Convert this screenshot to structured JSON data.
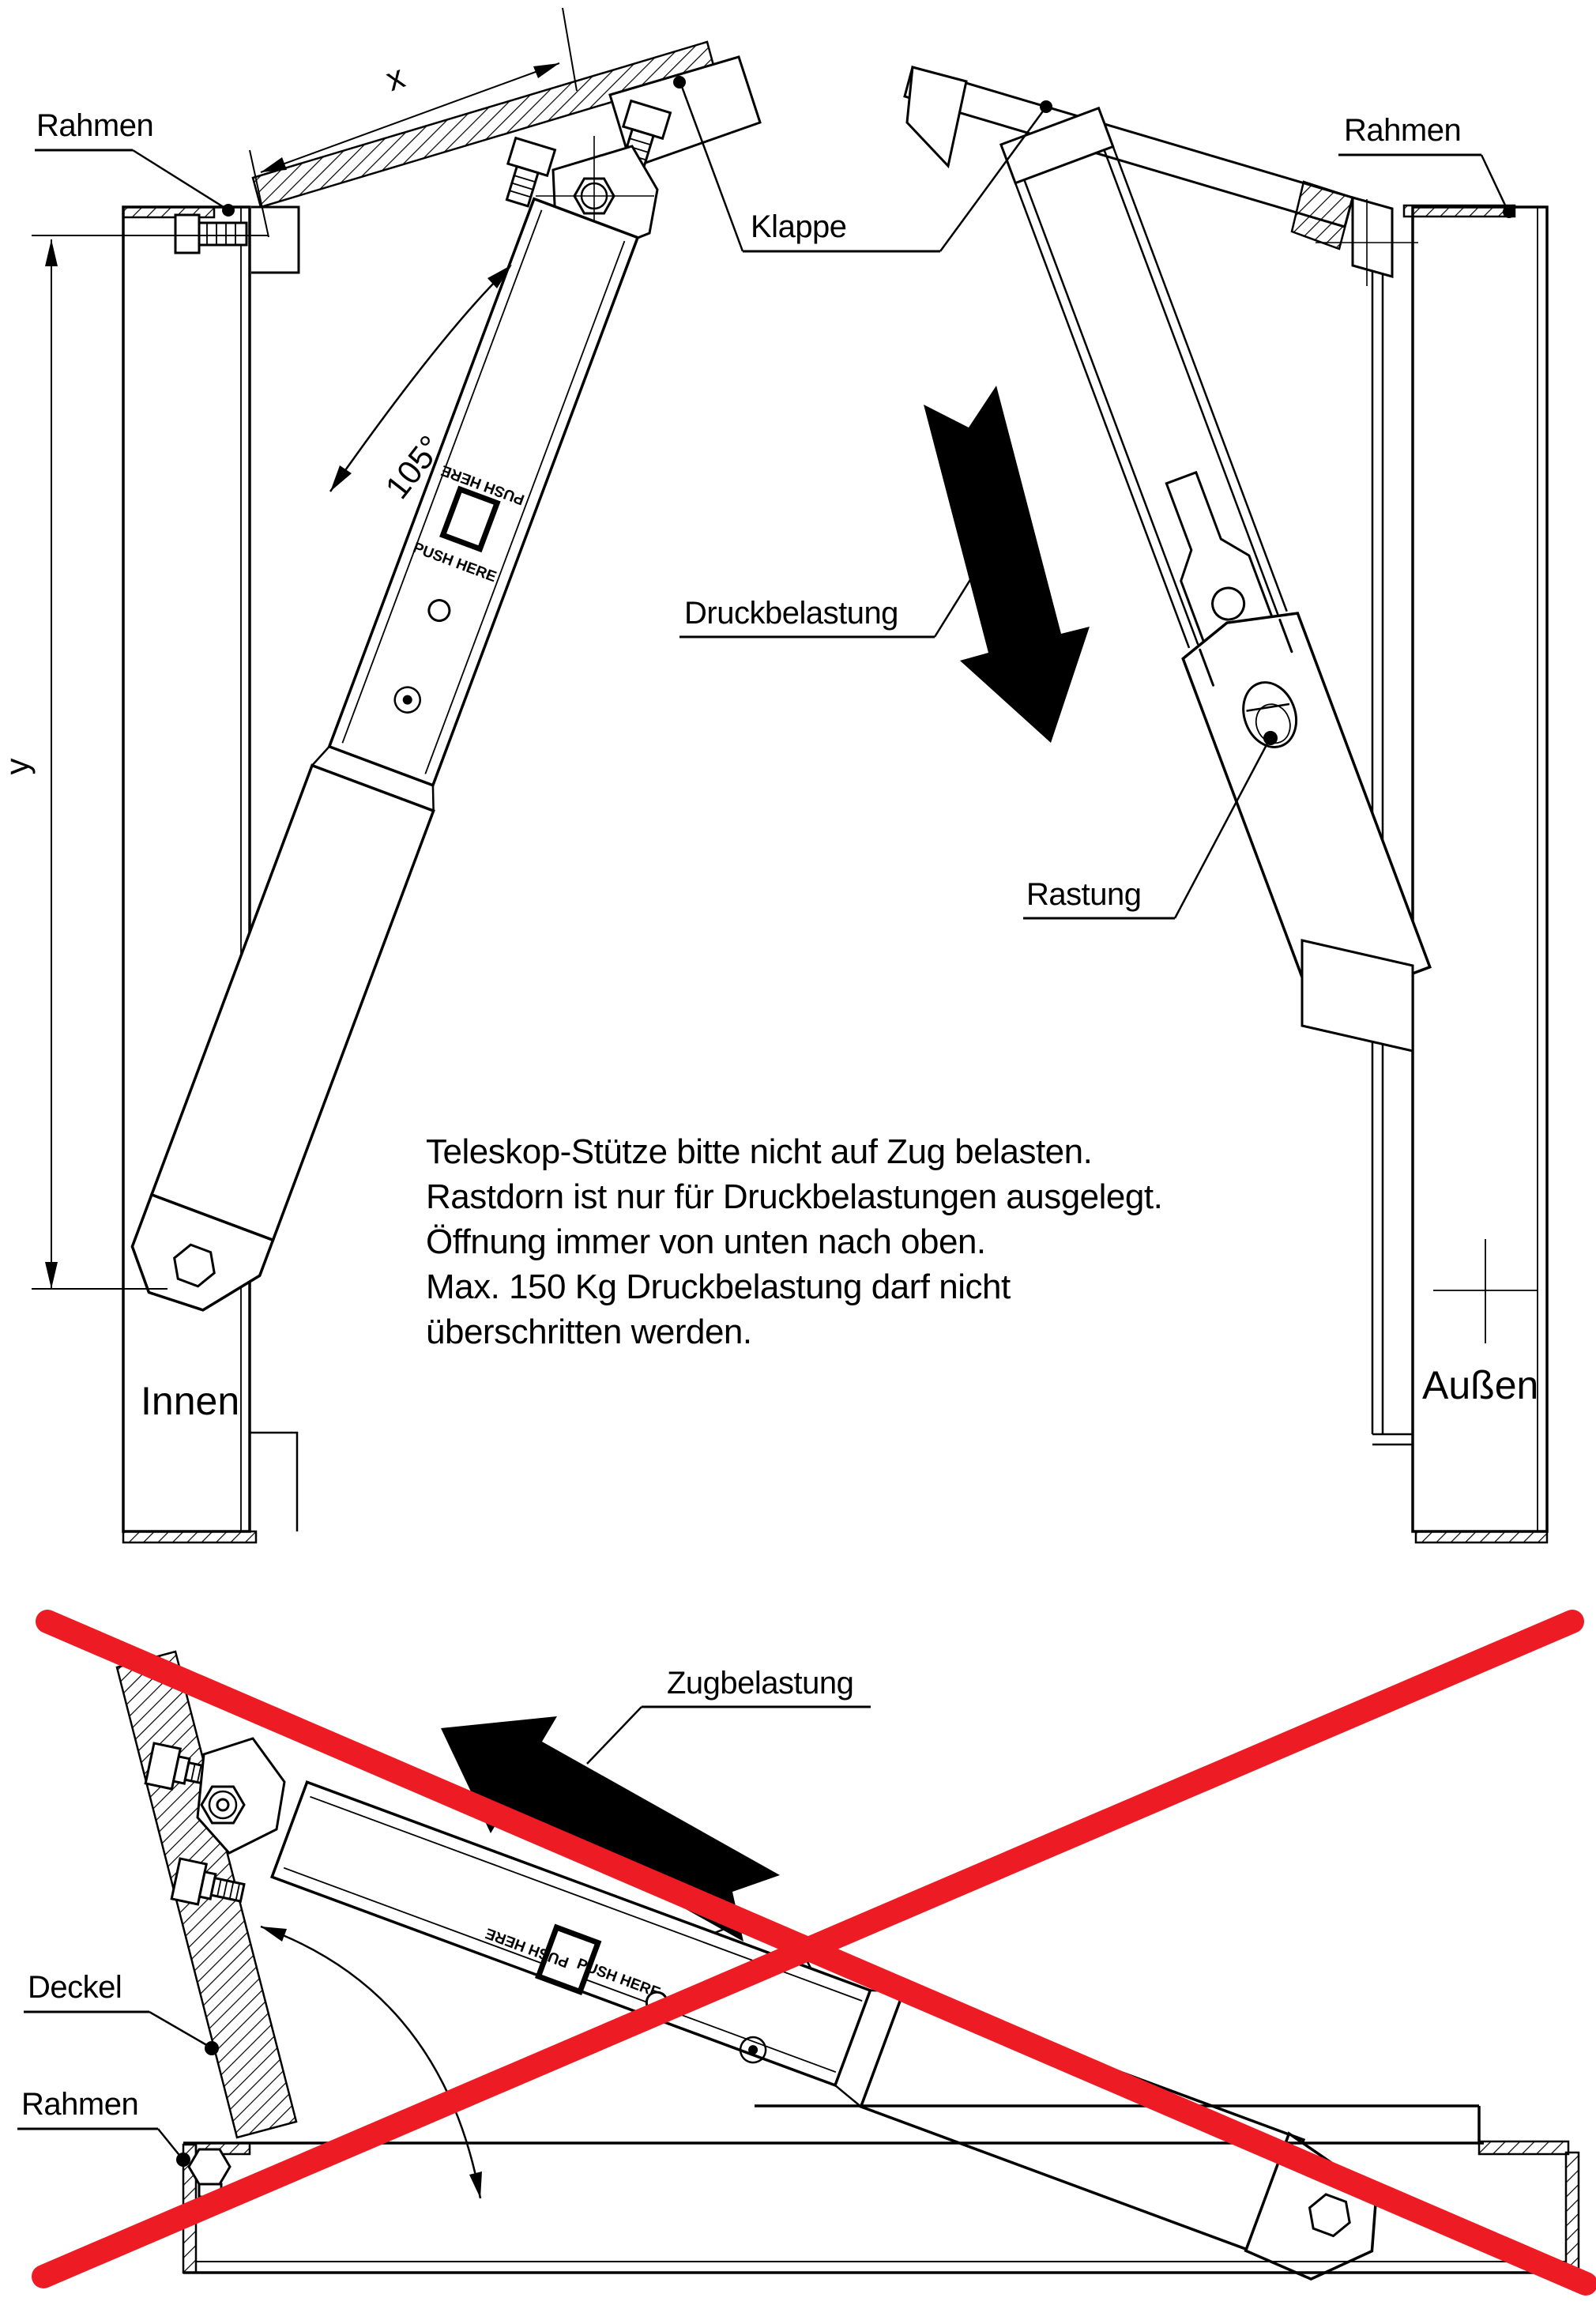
{
  "colors": {
    "ink": "#000000",
    "red": "#ed1c24",
    "paper": "#ffffff"
  },
  "top_view": {
    "labels": {
      "rahmen_left": "Rahmen",
      "rahmen_right": "Rahmen",
      "klappe": "Klappe",
      "druckbelastung": "Druckbelastung",
      "rastung": "Rastung",
      "innen": "Innen",
      "aussen": "Außen"
    },
    "dims": {
      "x": "x",
      "y": "y",
      "angle": "105°"
    },
    "strut_print": "PUSH HERE"
  },
  "note": {
    "lines": [
      "Teleskop-Stütze bitte nicht auf Zug belasten.",
      "Rastdorn ist nur für Druckbelastungen ausgelegt.",
      "Öffnung immer von unten nach oben.",
      "Max. 150 Kg Druckbelastung darf nicht",
      "überschritten werden."
    ]
  },
  "bottom_view": {
    "labels": {
      "zugbelastung": "Zugbelastung",
      "deckel": "Deckel",
      "rahmen": "Rahmen"
    },
    "strut_print": "PUSH HERE"
  }
}
